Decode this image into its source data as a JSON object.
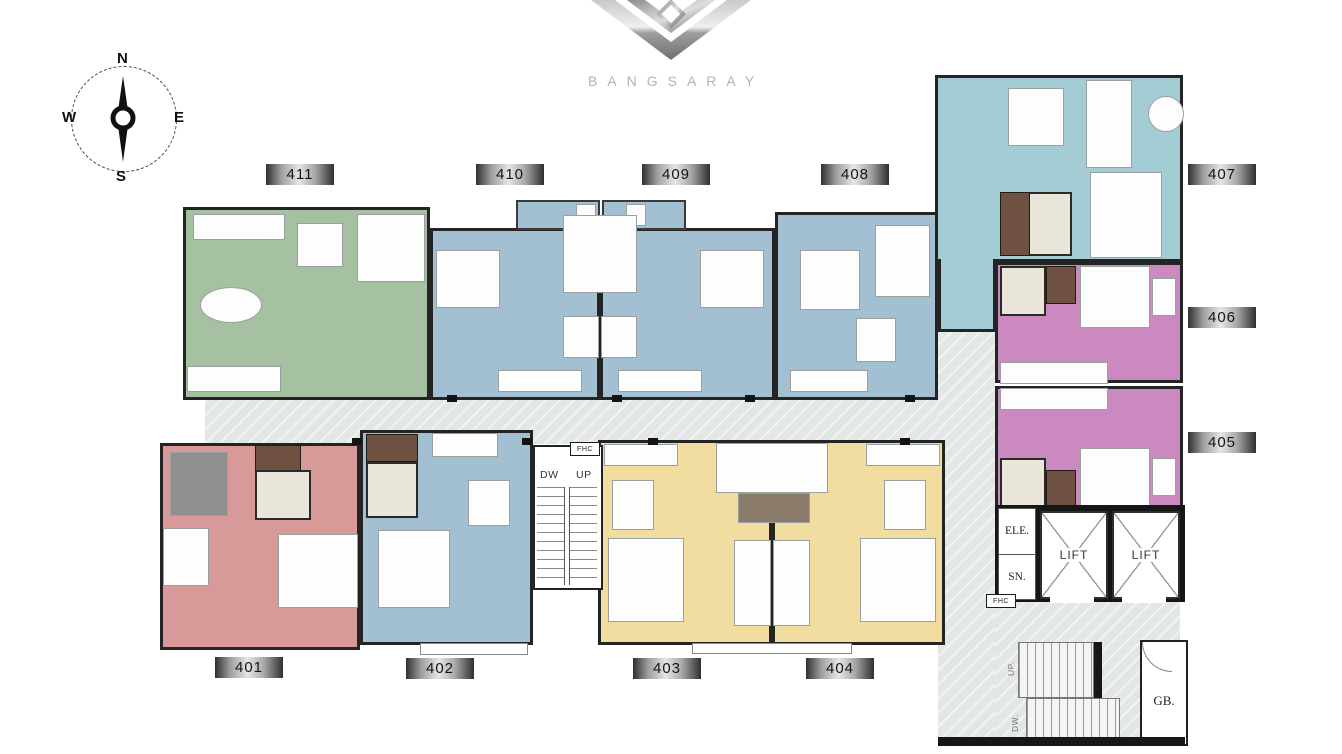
{
  "brand": {
    "name": "BANGSARAY"
  },
  "compass": {
    "north": "N",
    "east": "E",
    "south": "S",
    "west": "W"
  },
  "units": [
    {
      "number": "411",
      "color": "#a6c1a1"
    },
    {
      "number": "410",
      "color": "#a2c0d2"
    },
    {
      "number": "409",
      "color": "#a2c0d2"
    },
    {
      "number": "408",
      "color": "#a2c0d2"
    },
    {
      "number": "407",
      "color": "#a3ccd5"
    },
    {
      "number": "406",
      "color": "#cb8abf"
    },
    {
      "number": "405",
      "color": "#cb8abf"
    },
    {
      "number": "404",
      "color": "#f1dda0"
    },
    {
      "number": "403",
      "color": "#f1dda0"
    },
    {
      "number": "402",
      "color": "#a2c0d2"
    },
    {
      "number": "401",
      "color": "#d89a98"
    }
  ],
  "core": {
    "lift_left": "LIFT",
    "lift_right": "LIFT",
    "electrical_shaft": "ELE.",
    "sanitary_shaft": "SN.",
    "fire_hose_stair": "FHC",
    "fire_hose_lobby": "FHC",
    "stair_center_down": "DW",
    "stair_center_up": "UP",
    "stair_right_up": "UP.",
    "stair_right_down": "DW.",
    "garbage_room": "GB."
  },
  "colors": {
    "corridor": "#e2e7e6",
    "wall": "#242424",
    "bath_tile": "#eae6d9",
    "closet_wood": "#6e5140",
    "plate_metal_mid": "#e6e6e6",
    "plate_metal_edge": "#2f2f2f",
    "logo_silver": "#b3b3b3"
  }
}
